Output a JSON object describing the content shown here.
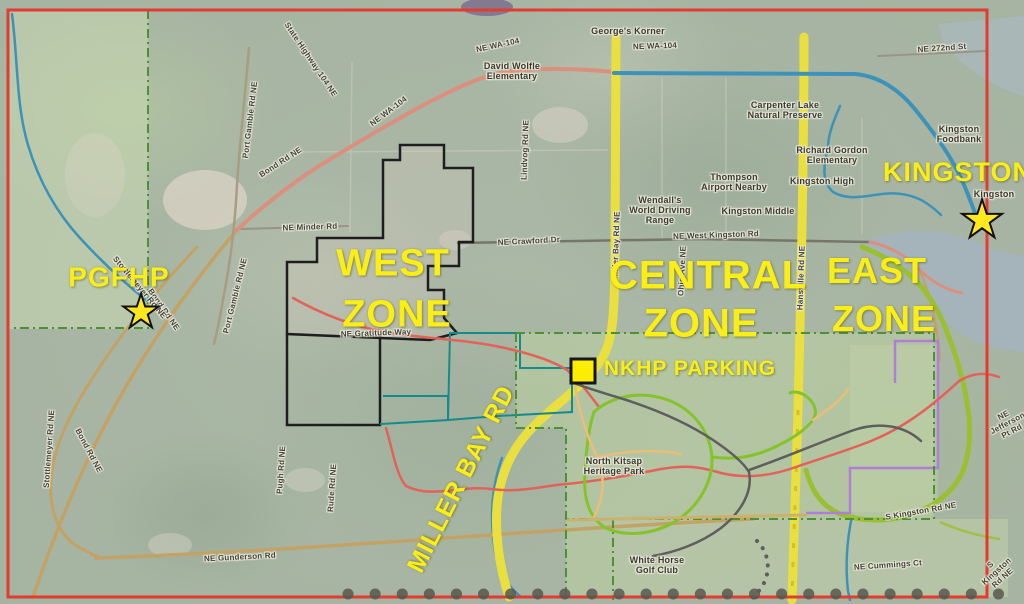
{
  "map": {
    "description": "Aerial trail-zone map of North Kitsap Heritage Park area, Kingston WA",
    "colors": {
      "border_red": "#e23b30",
      "zone_text_yellow": "#f9ee16",
      "major_road_yellow": "#e9e040",
      "highway_salmon": "#db8f7e",
      "highway_blue": "#3e92b8",
      "minor_road_tan": "#c3a266",
      "trail_red": "#e2625a",
      "trail_green": "#84c32a",
      "trail_gray": "#5e5e5e",
      "trail_orange": "#eabd79",
      "boundary_black": "#1e1e1e",
      "boundary_teal": "#178b8b",
      "boundary_purple": "#b07ed8",
      "boundary_green_dash": "#4d9038",
      "water": "#a4b4ba"
    },
    "yellow_labels": [
      {
        "name": "west-zone-label-line1",
        "text": "WEST",
        "x": 393,
        "y": 264,
        "size": 38
      },
      {
        "name": "west-zone-label-line2",
        "text": "ZONE",
        "x": 397,
        "y": 315,
        "size": 38
      },
      {
        "name": "central-zone-label-line1",
        "text": "CENTRAL",
        "x": 708,
        "y": 276,
        "size": 40
      },
      {
        "name": "central-zone-label-line2",
        "text": "ZONE",
        "x": 701,
        "y": 324,
        "size": 40
      },
      {
        "name": "east-zone-label-line1",
        "text": "EAST",
        "x": 877,
        "y": 271,
        "size": 36
      },
      {
        "name": "east-zone-label-line2",
        "text": "ZONE",
        "x": 884,
        "y": 319,
        "size": 36
      },
      {
        "name": "kingston-area-label",
        "text": "KINGSTON",
        "x": 958,
        "y": 172,
        "size": 27
      },
      {
        "name": "pgfhp-label",
        "text": "PGFHP",
        "x": 119,
        "y": 277,
        "size": 28
      },
      {
        "name": "nkhp-parking-label",
        "text": "NKHP PARKING",
        "x": 690,
        "y": 369,
        "size": 21
      },
      {
        "name": "miller-bay-rd-label",
        "text": "MILLER BAY RD",
        "x": 461,
        "y": 479,
        "size": 25,
        "rot": -63
      }
    ],
    "road_labels": [
      {
        "name": "road-label-state-highway-104-ne",
        "text": "State Highway 104 NE",
        "x": 310,
        "y": 60,
        "rot": 56
      },
      {
        "name": "road-label-ne-wa-104-a",
        "text": "NE WA-104",
        "x": 498,
        "y": 46,
        "rot": -12
      },
      {
        "name": "road-label-ne-wa-104-b",
        "text": "NE WA-104",
        "x": 389,
        "y": 112,
        "rot": -37
      },
      {
        "name": "road-label-ne-wa-104-c",
        "text": "NE WA-104",
        "x": 655,
        "y": 47,
        "rot": -2
      },
      {
        "name": "road-label-ne-272nd-st",
        "text": "NE 272nd St",
        "x": 942,
        "y": 49,
        "rot": -4
      },
      {
        "name": "road-label-bond-rd-ne-a",
        "text": "Bond Rd NE",
        "x": 281,
        "y": 163,
        "rot": -33
      },
      {
        "name": "road-label-bond-rd-ne-b",
        "text": "Bond Rd NE",
        "x": 163,
        "y": 310,
        "rot": 55
      },
      {
        "name": "road-label-bond-rd-ne-c",
        "text": "Bond Rd NE",
        "x": 88,
        "y": 451,
        "rot": 62
      },
      {
        "name": "road-label-port-gamble-rd-ne-a",
        "text": "Port Gamble Rd NE",
        "x": 251,
        "y": 120,
        "rot": -83
      },
      {
        "name": "road-label-port-gamble-rd-ne-b",
        "text": "Port Gamble Rd NE",
        "x": 236,
        "y": 296,
        "rot": -76
      },
      {
        "name": "road-label-lindvog-rd-ne",
        "text": "Lindvog Rd NE",
        "x": 526,
        "y": 150,
        "rot": -88
      },
      {
        "name": "road-label-ne-minder-rd",
        "text": "NE Minder Rd",
        "x": 310,
        "y": 228,
        "rot": -2
      },
      {
        "name": "road-label-stottlemeyer-rd-ne-a",
        "text": "Stottlemeyer Rd NE",
        "x": 139,
        "y": 288,
        "rot": 50
      },
      {
        "name": "road-label-stottlemeyer-rd-ne-b",
        "text": "Stottlemeyer Rd NE",
        "x": 50,
        "y": 449,
        "rot": -86
      },
      {
        "name": "road-label-ne-gunderson-rd",
        "text": "NE Gunderson Rd",
        "x": 240,
        "y": 558,
        "rot": -3
      },
      {
        "name": "road-label-ne-gratitude-way",
        "text": "NE Gratitude Way",
        "x": 376,
        "y": 334,
        "rot": -2
      },
      {
        "name": "road-label-ne-crawford-dr",
        "text": "NE Crawford Dr",
        "x": 529,
        "y": 242,
        "rot": -3
      },
      {
        "name": "road-label-ne-west-kingston-rd",
        "text": "NE West Kingston Rd",
        "x": 716,
        "y": 236,
        "rot": -2
      },
      {
        "name": "road-label-miller-bay-rd-ne",
        "text": "Miller Bay Rd NE",
        "x": 617,
        "y": 245,
        "rot": -88
      },
      {
        "name": "road-label-hansville-rd-ne",
        "text": "Hansville Rd NE",
        "x": 802,
        "y": 278,
        "rot": -88
      },
      {
        "name": "road-label-ohio-ave-ne",
        "text": "Ohio Ave NE",
        "x": 683,
        "y": 271,
        "rot": -87
      },
      {
        "name": "road-label-pugh-rd-ne",
        "text": "Pugh Rd NE",
        "x": 282,
        "y": 470,
        "rot": -86
      },
      {
        "name": "road-label-rude-rd-ne",
        "text": "Rude Rd NE",
        "x": 333,
        "y": 488,
        "rot": -86
      },
      {
        "name": "road-label-s-kingston-rd-ne-a",
        "text": "S Kingston Rd NE",
        "x": 921,
        "y": 512,
        "rot": -10
      },
      {
        "name": "road-label-ne-cummings-ct",
        "text": "NE Cummings Ct",
        "x": 888,
        "y": 566,
        "rot": -4
      },
      {
        "name": "road-label-ne-jefferson-pt-rd",
        "text": "NE Jefferson Pt Rd",
        "x": 1008,
        "y": 424,
        "rot": -28
      },
      {
        "name": "road-label-s-kingston-rd-ne-b",
        "text": "S Kingston Rd NE",
        "x": 997,
        "y": 572,
        "rot": -42
      }
    ],
    "place_labels": [
      {
        "name": "place-label-georges-korner",
        "text": "George's Korner",
        "x": 628,
        "y": 31
      },
      {
        "name": "place-label-david-wolfle-elementary",
        "text": "David Wolfle\nElementary",
        "x": 512,
        "y": 71
      },
      {
        "name": "place-label-carpenter-lake",
        "text": "Carpenter Lake\nNatural Preserve",
        "x": 785,
        "y": 110
      },
      {
        "name": "place-label-richard-gordon-elementary",
        "text": "Richard Gordon\nElementary",
        "x": 832,
        "y": 155
      },
      {
        "name": "place-label-thompson-airport",
        "text": "Thompson\nAirport Nearby",
        "x": 734,
        "y": 182
      },
      {
        "name": "place-label-kingston-high",
        "text": "Kingston High",
        "x": 822,
        "y": 181
      },
      {
        "name": "place-label-kingston-middle",
        "text": "Kingston Middle",
        "x": 758,
        "y": 211
      },
      {
        "name": "place-label-driving-range",
        "text": "Wendall's\nWorld Driving\nRange",
        "x": 660,
        "y": 210
      },
      {
        "name": "place-label-kingston-foodbank",
        "text": "Kingston\nFoodbank",
        "x": 959,
        "y": 134
      },
      {
        "name": "place-label-north-kitsap-heritage-park",
        "text": "North Kitsap\nHeritage Park",
        "x": 614,
        "y": 466
      },
      {
        "name": "place-label-white-horse-golf-club",
        "text": "White Horse\nGolf Club",
        "x": 657,
        "y": 565
      },
      {
        "name": "place-label-kingston-town",
        "text": "Kingston",
        "x": 994,
        "y": 194
      }
    ],
    "markers": [
      {
        "name": "pgfhp-star-marker",
        "type": "star",
        "x": 141,
        "y": 311,
        "size": 46
      },
      {
        "name": "kingston-star-marker",
        "type": "star",
        "x": 982,
        "y": 220,
        "size": 52
      },
      {
        "name": "nkhp-parking-square-marker",
        "type": "square",
        "x": 583,
        "y": 371,
        "size": 27
      }
    ]
  }
}
